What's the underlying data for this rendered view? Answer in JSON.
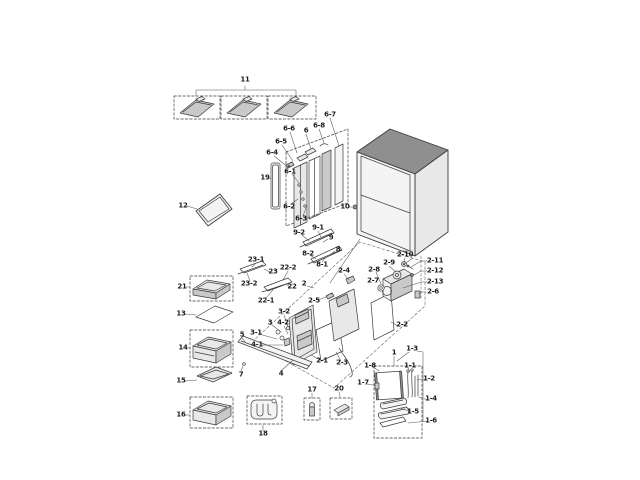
{
  "diagram": {
    "colors": {
      "background": "#ffffff",
      "line": "#3b3b3b",
      "leader": "#555555",
      "label_text": "#1c1c1c",
      "fill_light": "#e8e8e8",
      "fill_mid": "#c9c9c9",
      "fill_dark": "#8f8f8f"
    },
    "labels": [
      {
        "text": "11",
        "x": 245,
        "y": 80
      },
      {
        "text": "6-7",
        "x": 330,
        "y": 115
      },
      {
        "text": "6-8",
        "x": 319,
        "y": 126
      },
      {
        "text": "6",
        "x": 306,
        "y": 131
      },
      {
        "text": "6-6",
        "x": 289,
        "y": 129
      },
      {
        "text": "6-5",
        "x": 281,
        "y": 142
      },
      {
        "text": "6-4",
        "x": 272,
        "y": 153
      },
      {
        "text": "19",
        "x": 265,
        "y": 178
      },
      {
        "text": "6-1",
        "x": 290,
        "y": 172
      },
      {
        "text": "6-2",
        "x": 289,
        "y": 207
      },
      {
        "text": "6-3",
        "x": 301,
        "y": 219
      },
      {
        "text": "12",
        "x": 183,
        "y": 206
      },
      {
        "text": "10",
        "x": 345,
        "y": 207
      },
      {
        "text": "9-2",
        "x": 299,
        "y": 233
      },
      {
        "text": "9-1",
        "x": 318,
        "y": 228
      },
      {
        "text": "9",
        "x": 331,
        "y": 238
      },
      {
        "text": "8-2",
        "x": 308,
        "y": 254
      },
      {
        "text": "8",
        "x": 338,
        "y": 250
      },
      {
        "text": "8-1",
        "x": 322,
        "y": 265
      },
      {
        "text": "23-1",
        "x": 256,
        "y": 260
      },
      {
        "text": "23",
        "x": 273,
        "y": 272
      },
      {
        "text": "22-2",
        "x": 288,
        "y": 268
      },
      {
        "text": "23-2",
        "x": 249,
        "y": 284
      },
      {
        "text": "22",
        "x": 292,
        "y": 287
      },
      {
        "text": "2",
        "x": 304,
        "y": 284
      },
      {
        "text": "22-1",
        "x": 266,
        "y": 301
      },
      {
        "text": "2-5",
        "x": 314,
        "y": 301
      },
      {
        "text": "2-4",
        "x": 344,
        "y": 271
      },
      {
        "text": "2-8",
        "x": 374,
        "y": 270
      },
      {
        "text": "2-9",
        "x": 389,
        "y": 263
      },
      {
        "text": "2-10",
        "x": 405,
        "y": 255
      },
      {
        "text": "2-7",
        "x": 373,
        "y": 281
      },
      {
        "text": "2-11",
        "x": 435,
        "y": 261
      },
      {
        "text": "2-12",
        "x": 435,
        "y": 271
      },
      {
        "text": "2-13",
        "x": 435,
        "y": 282
      },
      {
        "text": "2-6",
        "x": 433,
        "y": 292
      },
      {
        "text": "2-2",
        "x": 402,
        "y": 325
      },
      {
        "text": "21",
        "x": 182,
        "y": 287
      },
      {
        "text": "13",
        "x": 181,
        "y": 314
      },
      {
        "text": "14",
        "x": 183,
        "y": 348
      },
      {
        "text": "15",
        "x": 181,
        "y": 381
      },
      {
        "text": "16",
        "x": 181,
        "y": 415
      },
      {
        "text": "3-2",
        "x": 284,
        "y": 312
      },
      {
        "text": "3",
        "x": 270,
        "y": 323
      },
      {
        "text": "4-2",
        "x": 283,
        "y": 323
      },
      {
        "text": "3-1",
        "x": 256,
        "y": 333
      },
      {
        "text": "5",
        "x": 242,
        "y": 335
      },
      {
        "text": "4-1",
        "x": 257,
        "y": 345
      },
      {
        "text": "7",
        "x": 241,
        "y": 375
      },
      {
        "text": "4",
        "x": 281,
        "y": 374
      },
      {
        "text": "2-1",
        "x": 322,
        "y": 361
      },
      {
        "text": "2-3",
        "x": 342,
        "y": 363
      },
      {
        "text": "18",
        "x": 263,
        "y": 434
      },
      {
        "text": "17",
        "x": 312,
        "y": 390
      },
      {
        "text": "20",
        "x": 339,
        "y": 389
      },
      {
        "text": "1",
        "x": 394,
        "y": 353
      },
      {
        "text": "1-3",
        "x": 412,
        "y": 349
      },
      {
        "text": "1-8",
        "x": 370,
        "y": 366
      },
      {
        "text": "1-1",
        "x": 410,
        "y": 366
      },
      {
        "text": "1-7",
        "x": 363,
        "y": 383
      },
      {
        "text": "1-2",
        "x": 429,
        "y": 379
      },
      {
        "text": "1-4",
        "x": 431,
        "y": 399
      },
      {
        "text": "1-5",
        "x": 413,
        "y": 412
      },
      {
        "text": "1-6",
        "x": 431,
        "y": 421
      }
    ]
  }
}
